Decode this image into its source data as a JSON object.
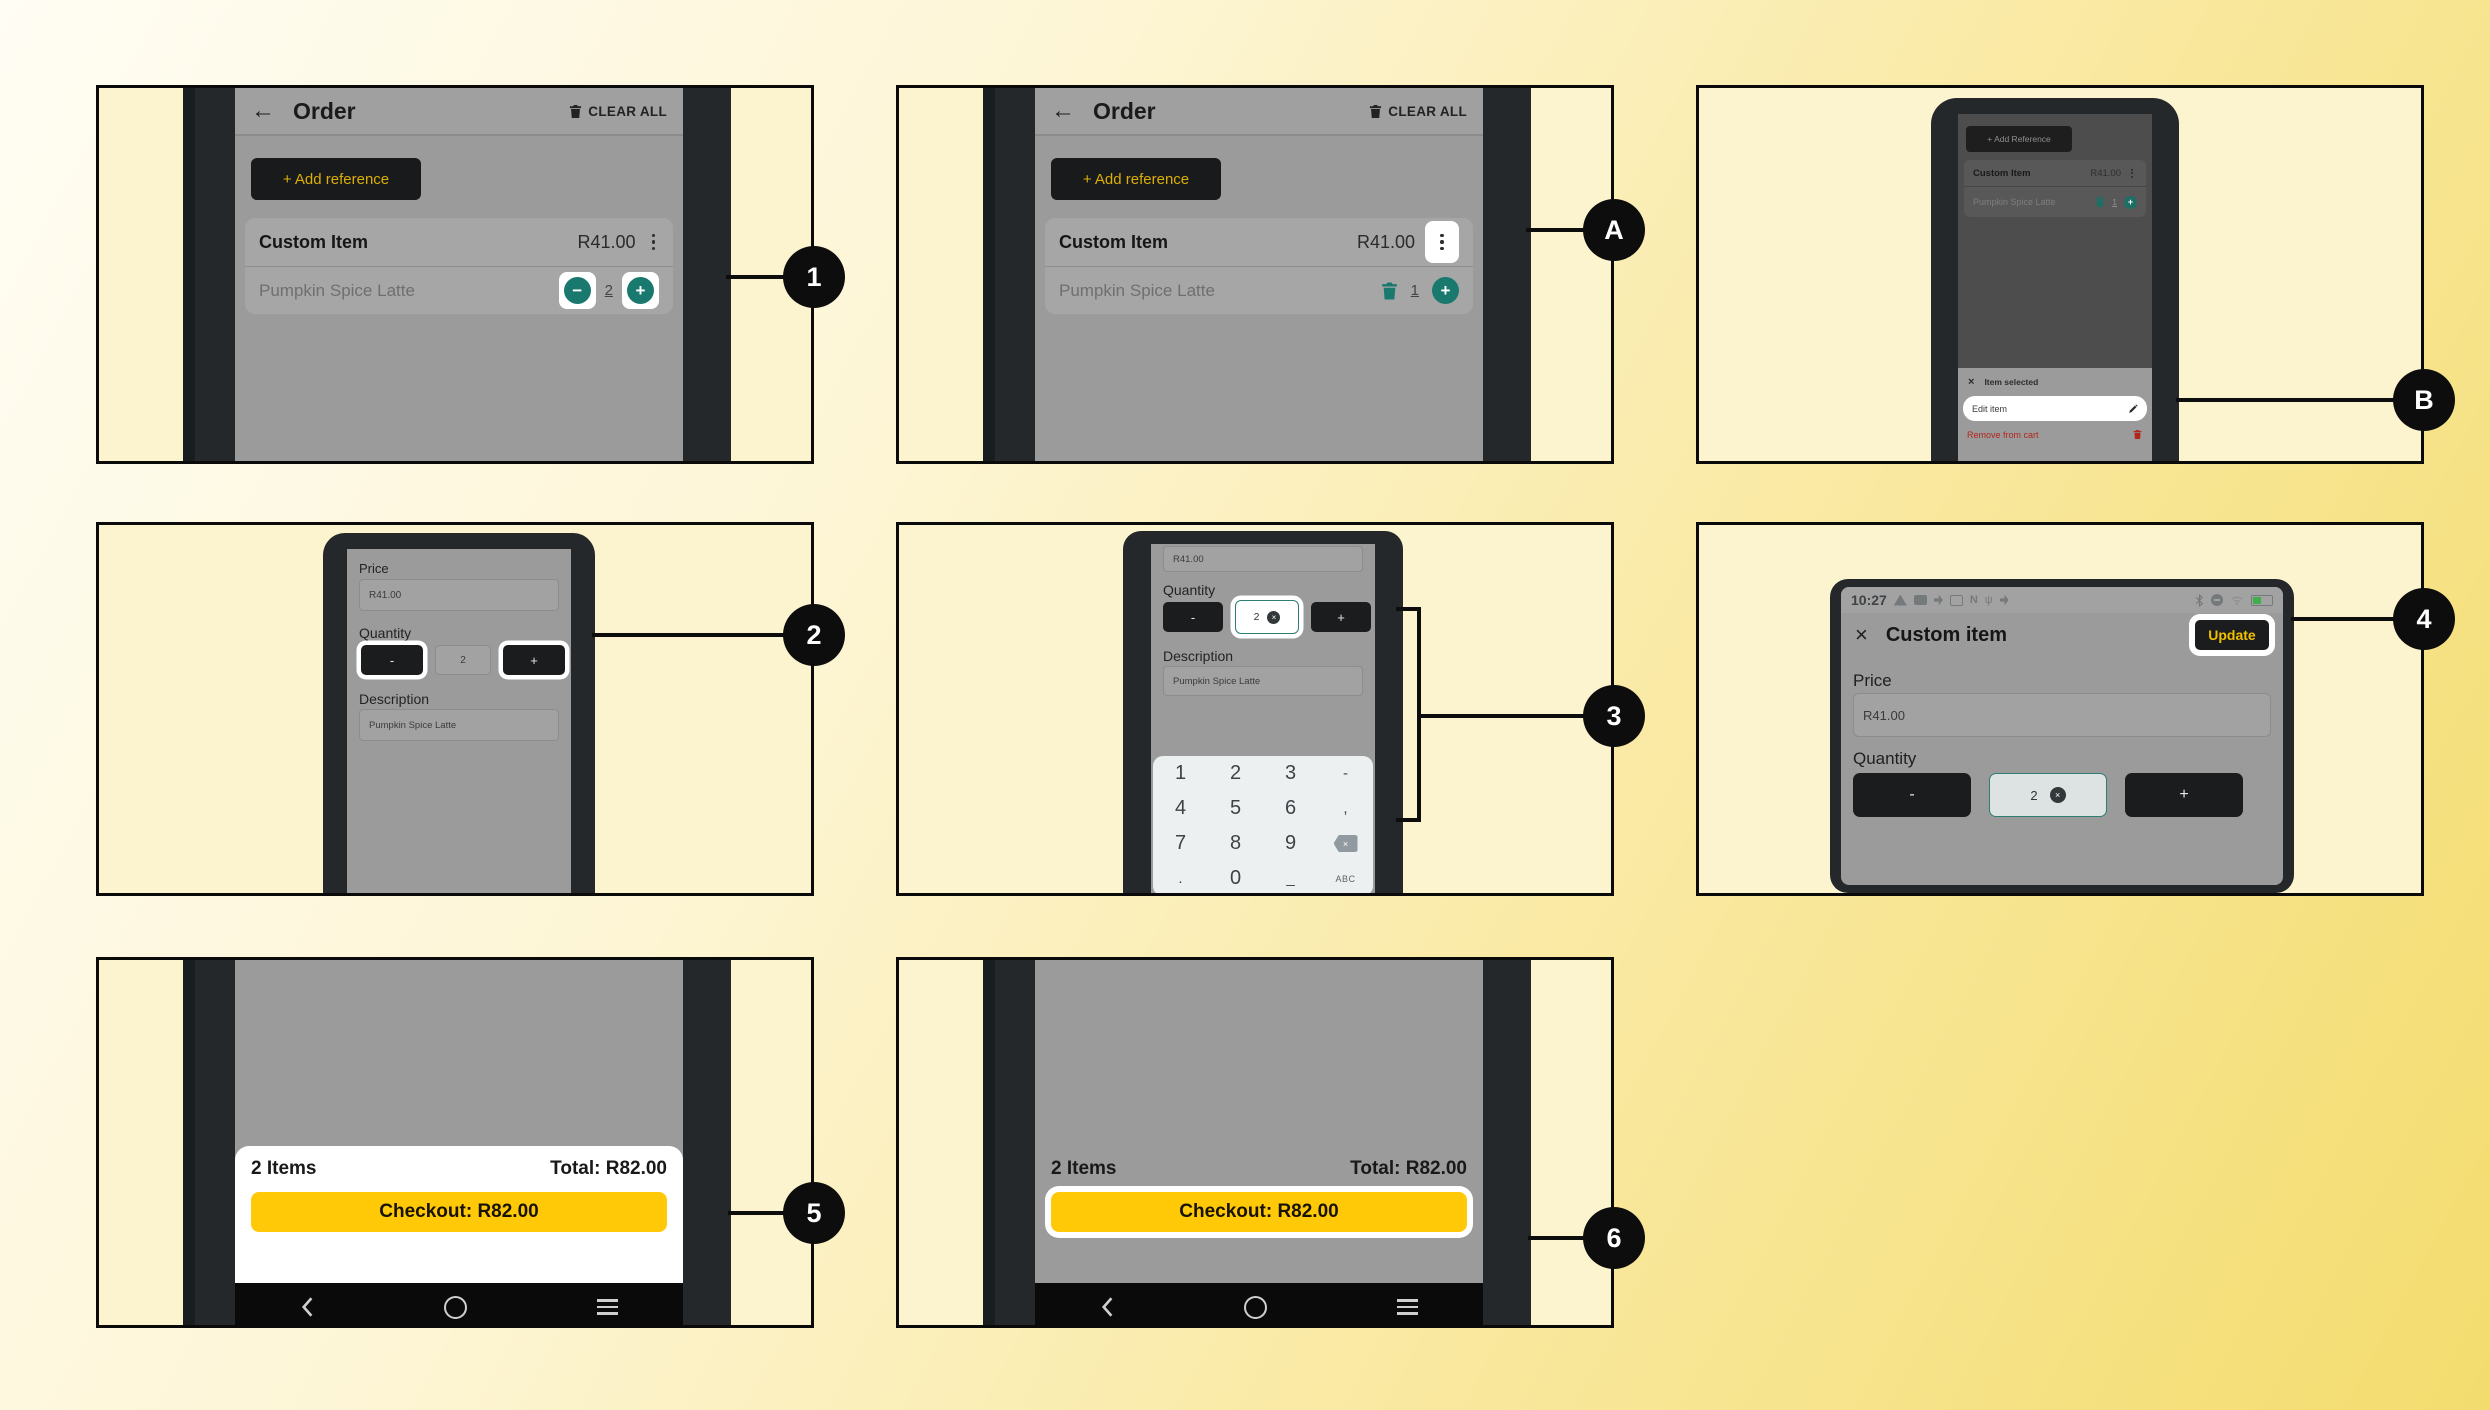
{
  "colors": {
    "background_yellow": "#f3dc6e",
    "panel_yellow": "#fcf3cf",
    "accent_yellow_text": "#dcae08",
    "checkout_yellow": "#ffc907",
    "teal": "#19796f",
    "danger_red": "#b3261e",
    "dark_button": "#1b1c1e",
    "screen_gray": "#9b9b9b"
  },
  "callouts": {
    "one": "1",
    "a": "A",
    "b": "B",
    "two": "2",
    "three": "3",
    "four": "4",
    "five": "5",
    "six": "6"
  },
  "icons": {
    "kebab": "vertical-ellipsis",
    "trash": "trash-can",
    "pencil": "edit-pencil",
    "backspace": "erase-left",
    "home": "circle",
    "recents": "hamburger",
    "back": "chevron-left"
  },
  "p1": {
    "back_arrow": "←",
    "title": "Order",
    "clear_all": "CLEAR ALL",
    "add_reference": "+ Add reference",
    "item_name": "Custom Item",
    "item_price": "R41.00",
    "item_desc": "Pumpkin Spice Latte",
    "minus": "−",
    "qty": "2",
    "plus": "+"
  },
  "pA": {
    "back_arrow": "←",
    "title": "Order",
    "clear_all": "CLEAR ALL",
    "add_reference": "+ Add reference",
    "item_name": "Custom Item",
    "item_price": "R41.00",
    "item_desc": "Pumpkin Spice Latte",
    "qty": "1",
    "plus": "+"
  },
  "pB": {
    "add_reference": "+ Add Reference",
    "item_name": "Custom Item",
    "item_price": "R41.00",
    "item_desc": "Pumpkin Spice Latte",
    "qty": "1",
    "plus": "+",
    "sheet_close": "×",
    "sheet_title": "Item selected",
    "edit_item": "Edit item",
    "remove_from_cart": "Remove from cart"
  },
  "p2": {
    "price_label": "Price",
    "price_value": "R41.00",
    "quantity_label": "Quantity",
    "minus": "-",
    "qty": "2",
    "plus": "+",
    "description_label": "Description",
    "description_value": "Pumpkin Spice Latte"
  },
  "p3": {
    "price_value": "R41.00",
    "quantity_label": "Quantity",
    "minus": "-",
    "qty": "2",
    "plus": "+",
    "description_label": "Description",
    "description_value": "Pumpkin Spice Latte",
    "keypad": {
      "r1": [
        "1",
        "2",
        "3",
        "-"
      ],
      "r2": [
        "4",
        "5",
        "6",
        ","
      ],
      "r3": [
        "7",
        "8",
        "9"
      ],
      "r4": [
        ".",
        "0",
        "_",
        "ABC"
      ]
    }
  },
  "p4": {
    "time": "10:27",
    "close": "×",
    "title": "Custom item",
    "update": "Update",
    "price_label": "Price",
    "price_value": "R41.00",
    "quantity_label": "Quantity",
    "minus": "-",
    "qty": "2",
    "plus": "+"
  },
  "p5": {
    "items": "2 Items",
    "total": "Total: R82.00",
    "checkout": "Checkout: R82.00"
  },
  "p6": {
    "items": "2 Items",
    "total": "Total: R82.00",
    "checkout": "Checkout: R82.00"
  }
}
